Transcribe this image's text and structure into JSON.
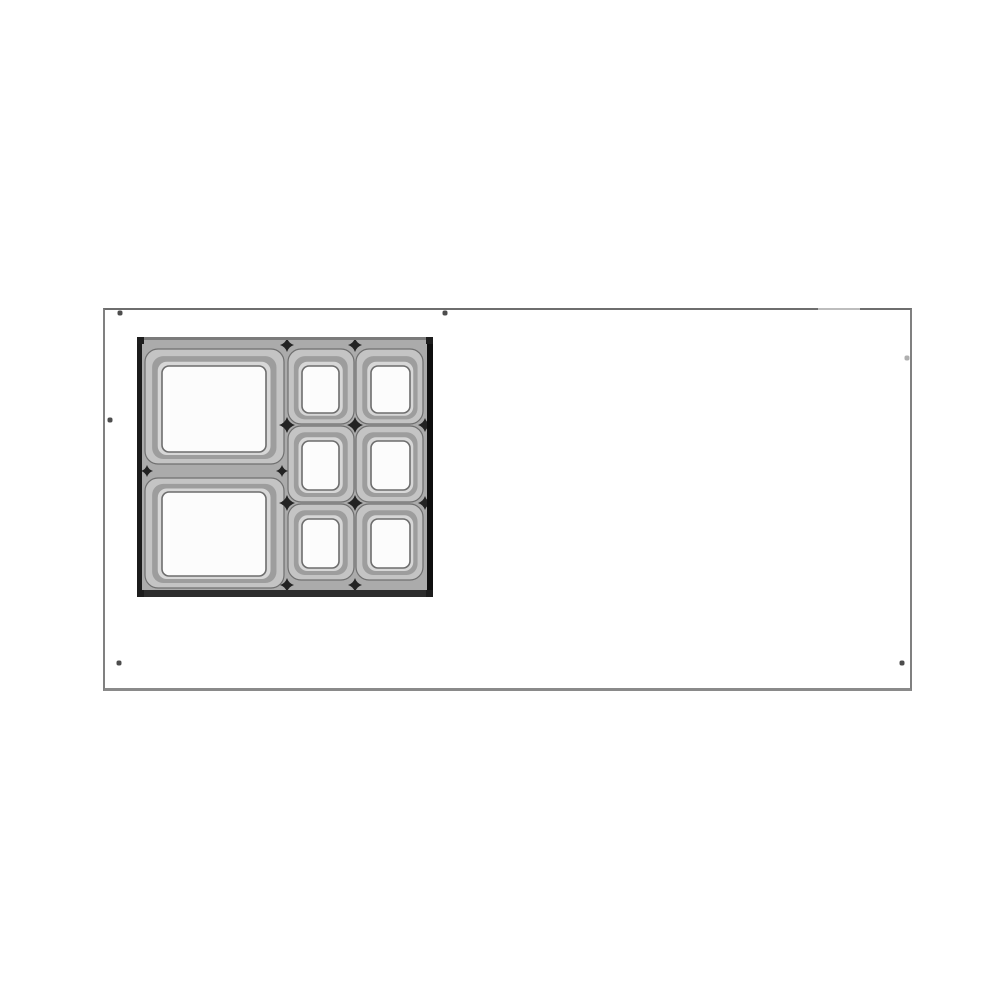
{
  "colors": {
    "page_bg": "#ffffff",
    "panel_top": "#6e6e6e",
    "panel_side": "#808080",
    "panel_bottom": "#8a8a8a",
    "hole": "#4d4d4d",
    "flange": "#ababab",
    "edge_left": "#1b1b1b",
    "edge_right": "#0f0f0f",
    "edge_top": "#7b7b7b",
    "edge_bottom": "#2d2d2d",
    "edge_corner": "#1d1d1d",
    "rim_outer": "#c4c4c4",
    "rim_stroke": "#6f6f6f",
    "rim_mid": "#9d9d9d",
    "rim_light": "#d7d7d7",
    "well_fill": "#fcfcfc",
    "well_stroke": "#6d6d6d",
    "star": "#232323"
  },
  "panel": {
    "x": 103,
    "y": 308,
    "w": 809,
    "h": 383,
    "holes": [
      {
        "x": 120,
        "y": 313
      },
      {
        "x": 445,
        "y": 313
      },
      {
        "x": 110,
        "y": 420
      },
      {
        "x": 119,
        "y": 663
      },
      {
        "x": 902,
        "y": 663
      },
      {
        "x": 907,
        "y": 358,
        "faint": true
      }
    ]
  },
  "insert": {
    "x": 137,
    "y": 337,
    "w": 296,
    "h": 260,
    "large_pan_count": 2,
    "small_pan_count": 6,
    "pans": [
      {
        "id": "large-top",
        "rim": [
          8,
          12,
          139,
          115
        ],
        "well": [
          25,
          29,
          104,
          86
        ]
      },
      {
        "id": "large-bottom",
        "rim": [
          8,
          141,
          139,
          110
        ],
        "well": [
          25,
          155,
          104,
          84
        ]
      },
      {
        "id": "small-mid-1",
        "rim": [
          151,
          12,
          66,
          75
        ],
        "well": [
          165,
          29,
          37,
          47
        ]
      },
      {
        "id": "small-mid-2",
        "rim": [
          151,
          89,
          66,
          76
        ],
        "well": [
          165,
          104,
          37,
          49
        ]
      },
      {
        "id": "small-mid-3",
        "rim": [
          151,
          167,
          66,
          76
        ],
        "well": [
          165,
          182,
          37,
          49
        ]
      },
      {
        "id": "small-right-1",
        "rim": [
          219,
          12,
          67,
          75
        ],
        "well": [
          234,
          29,
          39,
          47
        ]
      },
      {
        "id": "small-right-2",
        "rim": [
          219,
          89,
          67,
          76
        ],
        "well": [
          234,
          104,
          39,
          49
        ]
      },
      {
        "id": "small-right-3",
        "rim": [
          219,
          167,
          67,
          76
        ],
        "well": [
          234,
          182,
          39,
          49
        ]
      }
    ],
    "junctions": [
      {
        "x": 150,
        "y": 88,
        "s": 8
      },
      {
        "x": 218,
        "y": 88,
        "s": 8
      },
      {
        "x": 150,
        "y": 166,
        "s": 8
      },
      {
        "x": 218,
        "y": 166,
        "s": 8
      },
      {
        "x": 150,
        "y": 8,
        "s": 7
      },
      {
        "x": 218,
        "y": 8,
        "s": 7
      },
      {
        "x": 150,
        "y": 248,
        "s": 7
      },
      {
        "x": 218,
        "y": 248,
        "s": 7
      },
      {
        "x": 288,
        "y": 88,
        "s": 7
      },
      {
        "x": 288,
        "y": 166,
        "s": 7
      },
      {
        "x": 10,
        "y": 134,
        "s": 6
      },
      {
        "x": 145,
        "y": 134,
        "s": 6
      }
    ],
    "edges": {
      "top": [
        0,
        0,
        296,
        3
      ],
      "bottom": [
        0,
        253,
        296,
        7
      ],
      "left": [
        0,
        0,
        5,
        260
      ],
      "right": [
        290,
        0,
        6,
        260
      ]
    },
    "corners": [
      [
        0,
        0
      ],
      [
        289,
        0
      ],
      [
        0,
        253
      ],
      [
        289,
        253
      ]
    ]
  }
}
